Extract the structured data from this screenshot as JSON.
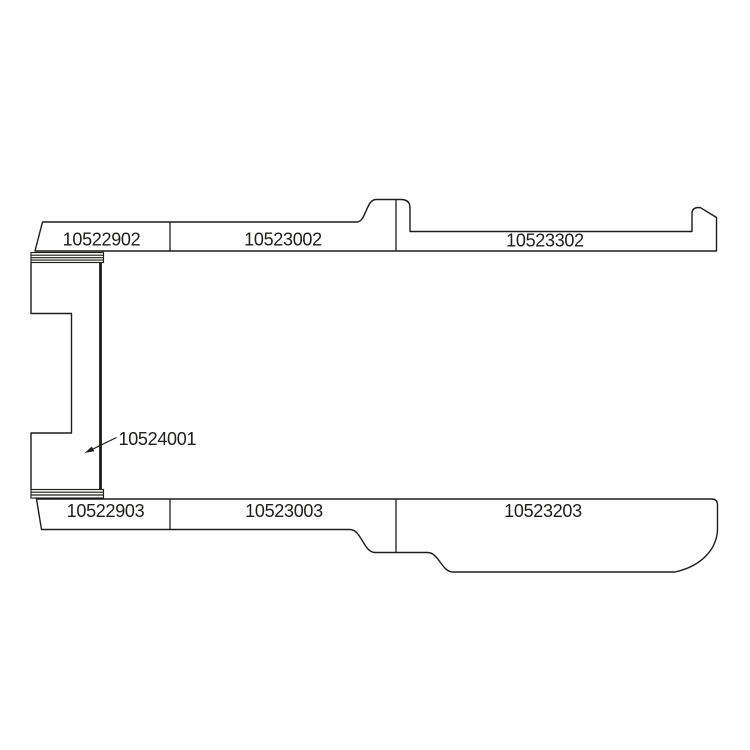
{
  "page": {
    "background_color": "#ffffff"
  },
  "diagram": {
    "type": "technical-parts-line-drawing",
    "line_color": "#1d1d1b",
    "text_color": "#1d1d1b",
    "top_row": {
      "parts": [
        {
          "part_number": "10522902"
        },
        {
          "part_number": "10523002"
        },
        {
          "part_number": "10523302"
        }
      ]
    },
    "left_column": {
      "part_number": "10524001"
    },
    "bottom_row": {
      "parts": [
        {
          "part_number": "10522903"
        },
        {
          "part_number": "10523003"
        },
        {
          "part_number": "10523203"
        }
      ]
    }
  }
}
